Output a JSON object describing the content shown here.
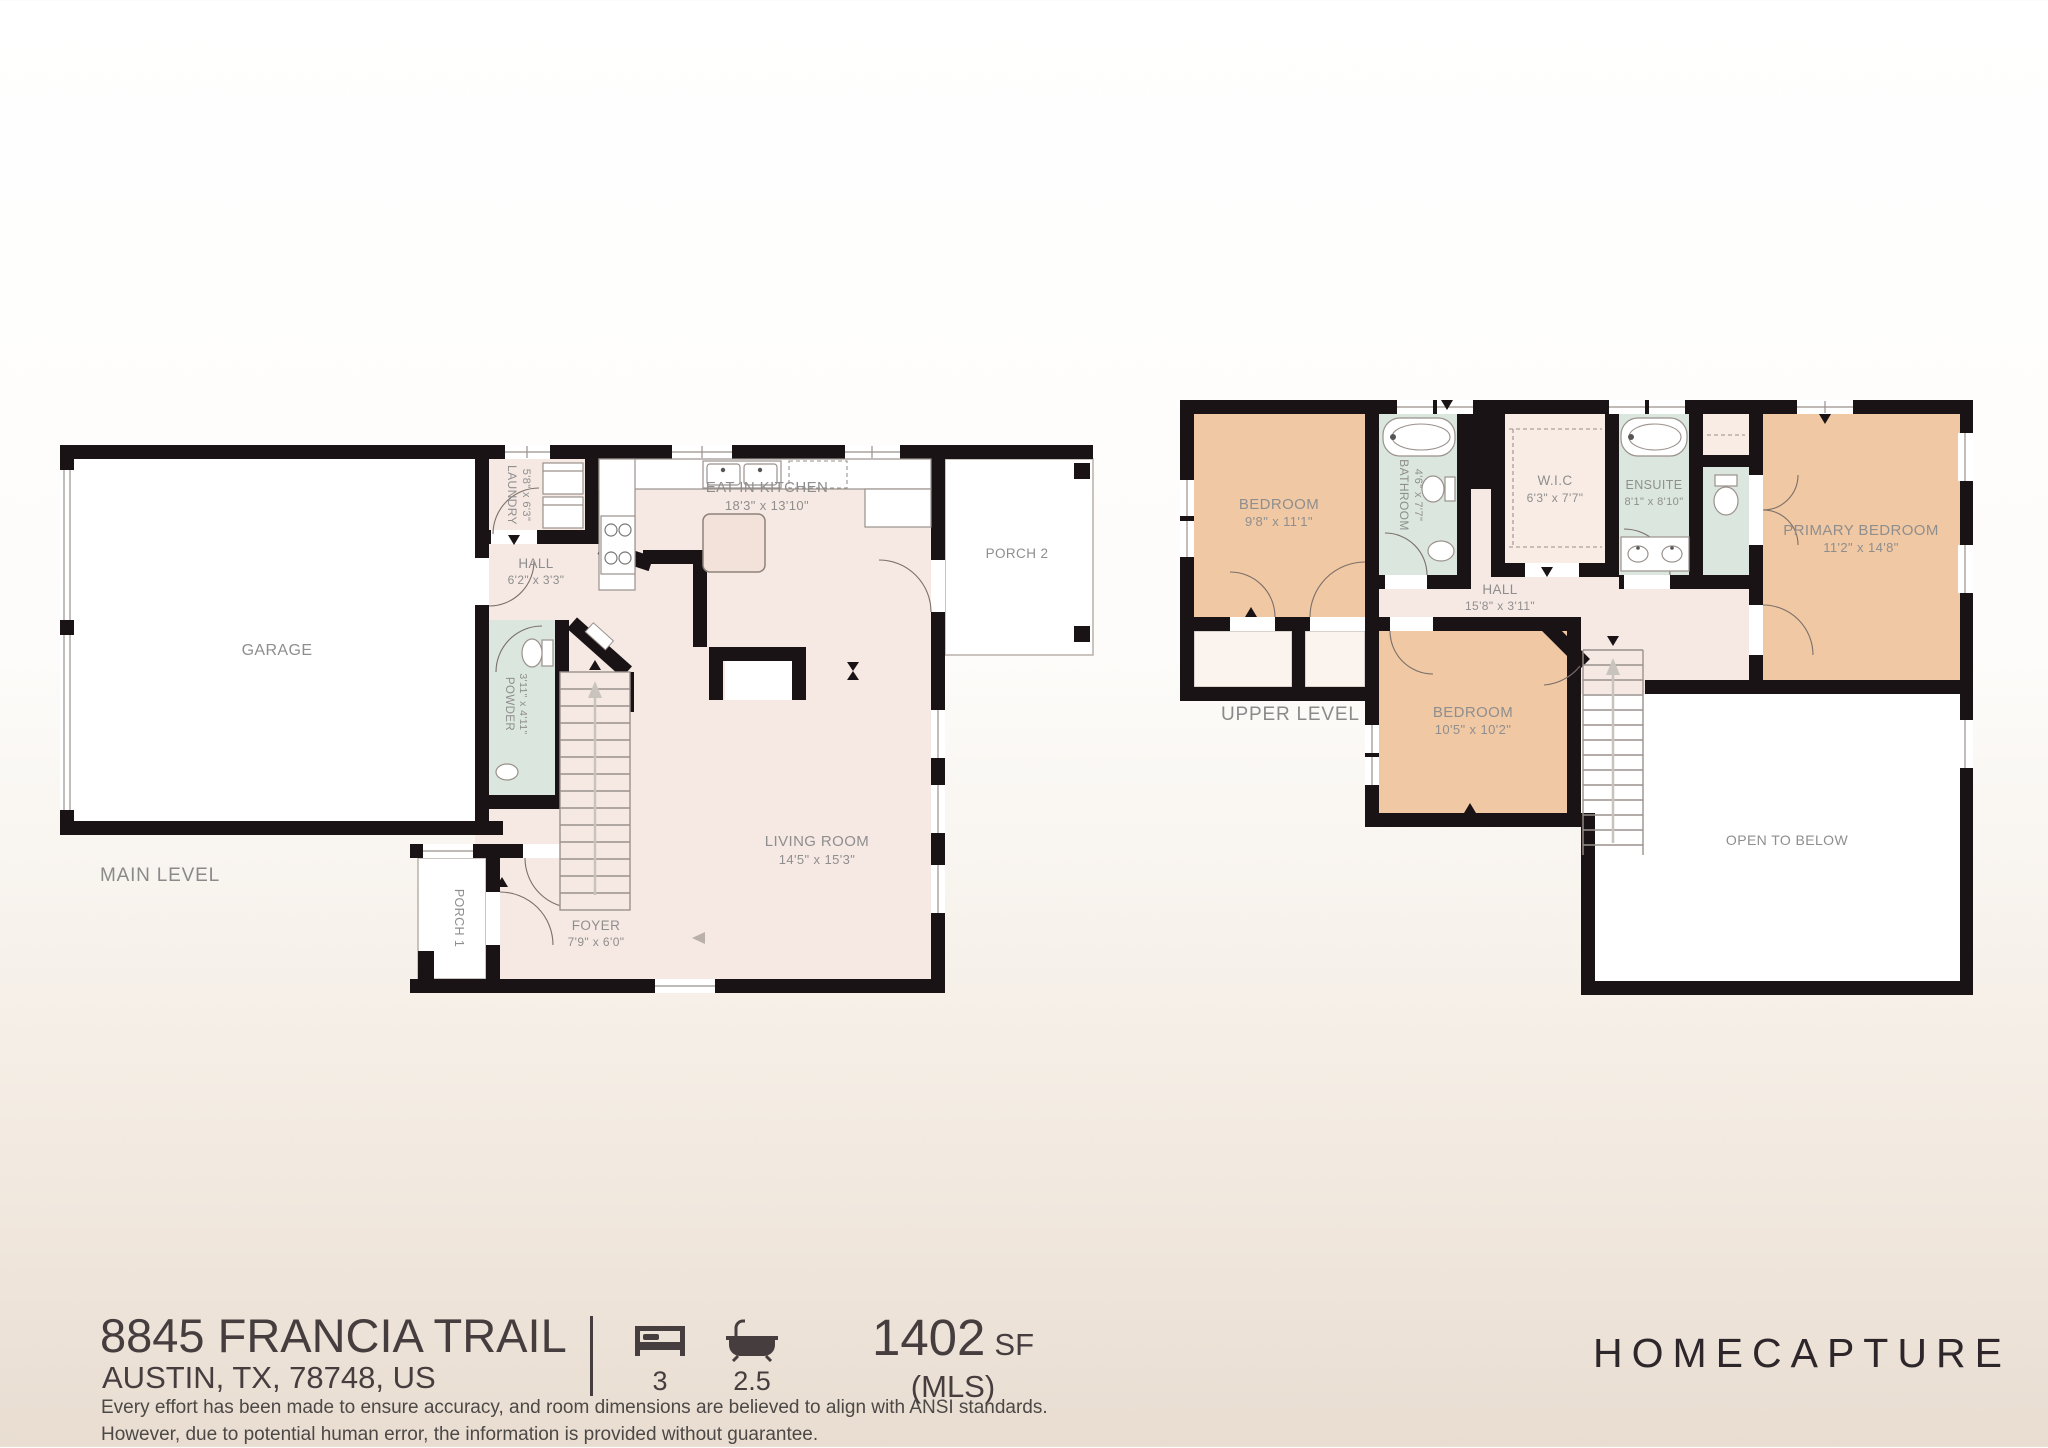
{
  "palette": {
    "wall": "#1a1316",
    "floor_pink": "#f6e9e3",
    "bedroom_tan": "#f0c8a3",
    "bath_teal": "#dbe6de",
    "white": "#ffffff",
    "label_gray": "#8f8e8e",
    "footer_dark": "#463d3f"
  },
  "main_level": {
    "label": "MAIN LEVEL",
    "garage": {
      "name": "GARAGE"
    },
    "laundry": {
      "name": "LAUNDRY",
      "dims": "5'8\" x 6'3\""
    },
    "kitchen": {
      "name": "EAT IN KITCHEN",
      "dims": "18'3\" x 13'10\""
    },
    "hall": {
      "name": "HALL",
      "dims": "6'2\" x 3'3\""
    },
    "powder": {
      "name": "POWDER",
      "dims": "3'11\" x 4'11\""
    },
    "living": {
      "name": "LIVING ROOM",
      "dims": "14'5\" x 15'3\""
    },
    "foyer": {
      "name": "FOYER",
      "dims": "7'9\" x 6'0\""
    },
    "porch1": {
      "name": "PORCH 1"
    },
    "porch2": {
      "name": "PORCH 2"
    }
  },
  "upper_level": {
    "label": "UPPER LEVEL",
    "bedroom1": {
      "name": "BEDROOM",
      "dims": "9'8\" x 11'1\""
    },
    "bathroom": {
      "name": "BATHROOM",
      "dims": "4'6\" x 7'7\""
    },
    "wic": {
      "name": "W.I.C",
      "dims": "6'3\" x 7'7\""
    },
    "ensuite": {
      "name": "ENSUITE",
      "dims": "8'1\" x 8'10\""
    },
    "primary": {
      "name": "PRIMARY BEDROOM",
      "dims": "11'2\" x 14'8\""
    },
    "h all": "",
    "hall": {
      "name": "HALL",
      "dims": "15'8\" x 3'11\""
    },
    "bedroom2": {
      "name": "BEDROOM",
      "dims": "10'5\" x 10'2\""
    },
    "open_below": {
      "name": "OPEN TO BELOW"
    }
  },
  "footer": {
    "address_line1": "8845 FRANCIA TRAIL",
    "address_line2": "AUSTIN, TX, 78748, US",
    "beds": "3",
    "baths": "2.5",
    "area_value": "1402",
    "area_unit": "SF",
    "area_source": "(MLS)",
    "brand": "HOMECAPTURE",
    "disclaimer_line1": "Every effort has been made to ensure accuracy, and room dimensions are believed to align with ANSI standards.",
    "disclaimer_line2": "However, due to potential human error, the information is provided without guarantee."
  }
}
